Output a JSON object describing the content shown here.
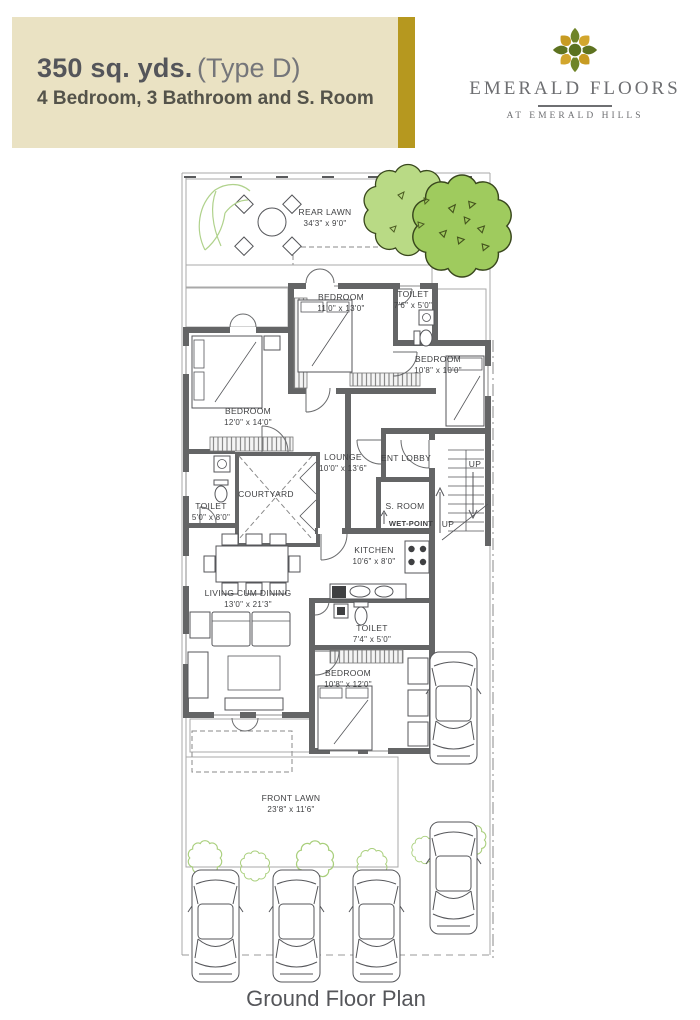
{
  "header": {
    "title": "350 sq. yds.",
    "title_suffix": "(Type D)",
    "subtitle": "4 Bedroom, 3 Bathroom and S. Room"
  },
  "brand": {
    "name": "EMERALD FLOORS",
    "tagline": "AT EMERALD HILLS",
    "logo": "flower-rosette-icon"
  },
  "footer": {
    "caption": "Ground Floor Plan"
  },
  "plan": {
    "rear_lawn": {
      "name": "REAR LAWN",
      "dims": "34'3\" x 9'0\""
    },
    "front_lawn": {
      "name": "FRONT LAWN",
      "dims": "23'8\" x 11'6\""
    },
    "bedroom_top": {
      "name": "BEDROOM",
      "dims": "11'0\" x 13'0\""
    },
    "toilet_top": {
      "name": "TOILET",
      "dims": "7'6\" x 5'0\""
    },
    "bedroom_right": {
      "name": "BEDROOM",
      "dims": "10'8\" x 10'0\""
    },
    "bedroom_left": {
      "name": "BEDROOM",
      "dims": "12'0\" x 14'0\""
    },
    "lounge": {
      "name": "LOUNGE",
      "dims": "10'0\" x 13'6\""
    },
    "ent_lobby": {
      "name": "ENT LOBBY"
    },
    "courtyard": {
      "name": "COURTYARD"
    },
    "toilet_left": {
      "name": "TOILET",
      "dims": "5'0\" x 8'0\""
    },
    "s_room": {
      "name": "S. ROOM"
    },
    "wet_point": {
      "name": "WET-POINT"
    },
    "kitchen": {
      "name": "KITCHEN",
      "dims": "10'6\" x 8'0\""
    },
    "living_dining": {
      "name": "LIVING CUM DINING",
      "dims": "13'0\" x 21'3\""
    },
    "toilet_mid": {
      "name": "TOILET",
      "dims": "7'4\" x 5'0\""
    },
    "bedroom_bottom": {
      "name": "BEDROOM",
      "dims": "10'8\" x 12'0\""
    },
    "stairs": {
      "up_top": "UP",
      "up_bottom": "UP"
    }
  },
  "colors": {
    "header_bg": "#EAE2C3",
    "accent_gold": "#B6981F",
    "title_text": "#54555A",
    "lawn_green": "#DFEAD3",
    "tree_light": "#B9DA85",
    "tree_dark": "#9FCB5E",
    "wall_gray": "#646566",
    "logo_olive": "#6F8428",
    "logo_gold": "#D2A62D",
    "logo_center": "#5B7220"
  }
}
